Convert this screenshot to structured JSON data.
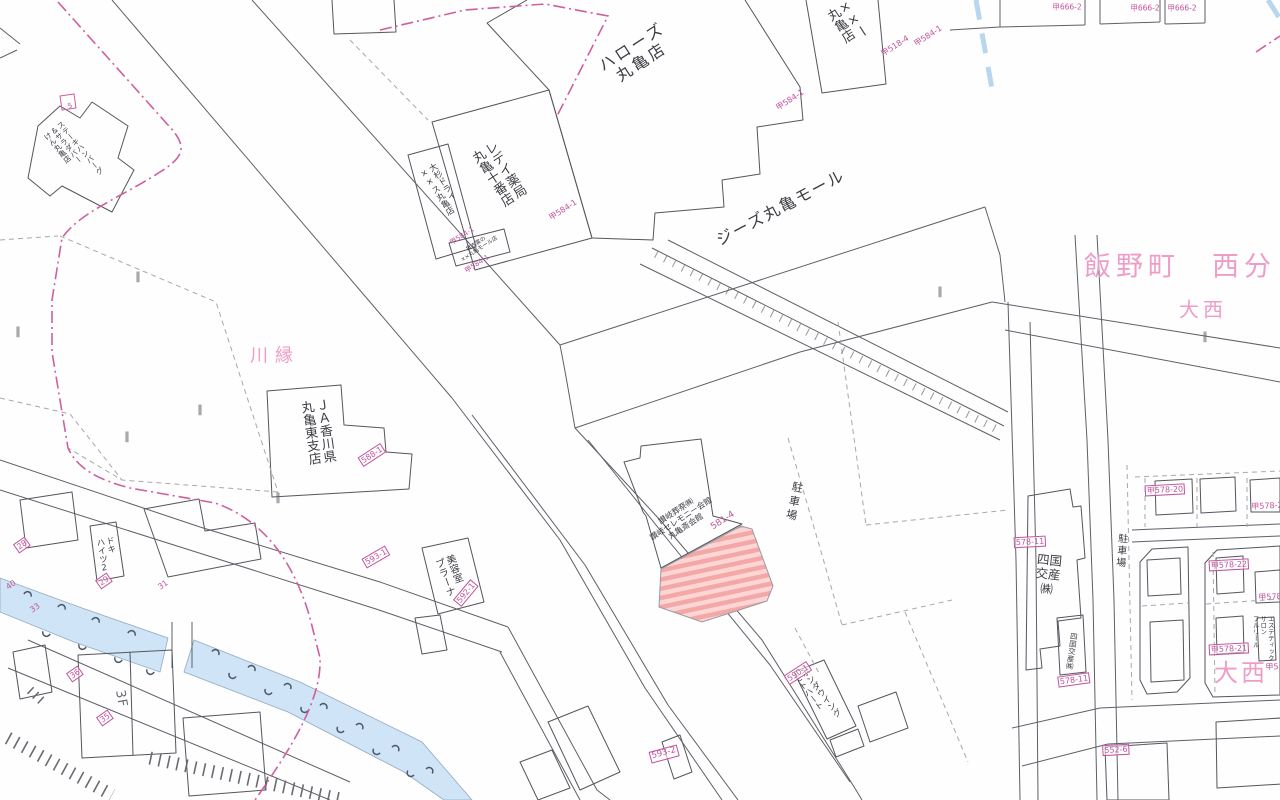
{
  "map": {
    "colors": {
      "parcel_number_pink": "#c2539c",
      "place_name_pink": "#ee9dc8",
      "boundary_pink": "#cf5f9f",
      "line_gray": "#5f5f68",
      "river_blue": "#cfe4f6",
      "hatch_pink_dark": "#f3a7a6",
      "hatch_pink_light": "#fbd6d5"
    },
    "highlighted_parcel": "581-4"
  },
  "labels": [
    {
      "n": "label-halows-marugame",
      "t": "ハローズ\n丸亀店",
      "x": 637,
      "y": 55,
      "r": -33,
      "s": 16,
      "c": "dark",
      "ls": 3
    },
    {
      "n": "label-gies-marugame-mall",
      "t": "ジーズ丸亀モール",
      "x": 781,
      "y": 208,
      "r": -28,
      "s": 16,
      "c": "dark",
      "ls": 2
    },
    {
      "n": "label-redei-pharmacy",
      "t": "レデイ薬局\n丸亀十番店",
      "x": 497,
      "y": 175,
      "r": -33,
      "s": 13,
      "c": "dark",
      "v": true
    },
    {
      "n": "label-osugi-dry",
      "t": "大杉ドライ\n××ス丸亀店",
      "x": 440,
      "y": 190,
      "r": -33,
      "s": 8.5,
      "c": "dark",
      "v": true
    },
    {
      "n": "label-rental-shop",
      "t": "貸衣裳の\n××丸亀モール店",
      "x": 478,
      "y": 247,
      "r": -33,
      "s": 5.5,
      "c": "dark"
    },
    {
      "n": "label-top-store",
      "t": "××ー\n丸亀店",
      "x": 846,
      "y": 24,
      "r": -33,
      "s": 13,
      "c": "dark",
      "v": true
    },
    {
      "n": "label-steak-ken",
      "t": "ステーキハンバーグ\n＆サラダバー\nけん丸亀店",
      "x": 73,
      "y": 154,
      "r": -40,
      "s": 7.5,
      "c": "dark",
      "v": true
    },
    {
      "n": "label-kawaberi",
      "t": "川縁",
      "x": 275,
      "y": 357,
      "r": 0,
      "s": 18,
      "c": "place",
      "ls": 7
    },
    {
      "n": "label-ja-kagawa",
      "t": "ＪＡ香川県\n丸亀東支店",
      "x": 316,
      "y": 432,
      "r": -8,
      "s": 13,
      "c": "dark",
      "v": true
    },
    {
      "n": "label-iinocho-nishibun",
      "t": "飯野町　西分",
      "x": 1180,
      "y": 267,
      "r": 0,
      "s": 27,
      "c": "place",
      "ls": 5
    },
    {
      "n": "label-onishi-small",
      "t": "大西",
      "x": 1203,
      "y": 310,
      "r": 0,
      "s": 20,
      "c": "place",
      "ls": 4
    },
    {
      "n": "label-onishi-large",
      "t": "大西",
      "x": 1241,
      "y": 674,
      "r": 0,
      "s": 24,
      "c": "place",
      "ls": 3
    },
    {
      "n": "label-sanuki-ceremony",
      "t": "讃岐葬祭㈱\n讃岐セレモニー会館\n丸亀斎会館",
      "x": 681,
      "y": 519,
      "r": -33,
      "s": 8,
      "c": "dark"
    },
    {
      "n": "label-parking-center",
      "t": "駐車場",
      "x": 793,
      "y": 502,
      "r": 12,
      "s": 11,
      "c": "dark",
      "v": true,
      "ls": 3
    },
    {
      "n": "label-parking-right",
      "t": "駐車場",
      "x": 1120,
      "y": 551,
      "r": 5,
      "s": 10,
      "c": "dark",
      "v": true,
      "ls": 2
    },
    {
      "n": "label-honda-wing",
      "t": "ホンダウイング\nモトハート",
      "x": 816,
      "y": 697,
      "r": -38,
      "s": 8.5,
      "c": "dark",
      "v": true
    },
    {
      "n": "label-biyoshitsu-prana",
      "t": "美容室\nプラーナ",
      "x": 449,
      "y": 576,
      "r": -20,
      "s": 10,
      "c": "dark",
      "v": true
    },
    {
      "n": "label-doki-heights",
      "t": "ドキ\nハイツ2",
      "x": 106,
      "y": 555,
      "r": -10,
      "s": 8.5,
      "c": "dark",
      "v": true
    },
    {
      "n": "label-shikoku-kosan",
      "t": "四国\n交産\n㈱",
      "x": 1048,
      "y": 575,
      "r": 6,
      "s": 12.5,
      "c": "dark"
    },
    {
      "n": "label-shikoku-kosan-small",
      "t": "四国交産㈱",
      "x": 1071,
      "y": 651,
      "r": 8,
      "s": 7.5,
      "c": "dark",
      "v": true
    },
    {
      "n": "label-esthetic-salon",
      "t": "エステティック\nサロン\nフルリール",
      "x": 1262,
      "y": 638,
      "r": 0,
      "s": 6.5,
      "c": "dark",
      "v": true
    },
    {
      "n": "label-3f",
      "t": "3F",
      "x": 120,
      "y": 699,
      "r": 80,
      "s": 13,
      "c": "gray",
      "ls": 1
    },
    {
      "n": "parcel-ko584-1-a",
      "t": "甲584-1",
      "x": 790,
      "y": 100,
      "r": -33,
      "s": 8,
      "c": "pink"
    },
    {
      "n": "parcel-ko518-4",
      "t": "甲518-4",
      "x": 895,
      "y": 46,
      "r": -33,
      "s": 8,
      "c": "pink"
    },
    {
      "n": "parcel-ko584-1-b",
      "t": "甲584-1",
      "x": 928,
      "y": 36,
      "r": -33,
      "s": 8,
      "c": "pink"
    },
    {
      "n": "parcel-ko584-1-c",
      "t": "甲584-1",
      "x": 563,
      "y": 210,
      "r": -33,
      "s": 8,
      "c": "pink"
    },
    {
      "n": "parcel-ko584-1-d",
      "t": "甲584-1",
      "x": 462,
      "y": 236,
      "r": -33,
      "s": 7,
      "c": "pink"
    },
    {
      "n": "parcel-ko584-1-e",
      "t": "甲584-1",
      "x": 477,
      "y": 264,
      "r": -33,
      "s": 7,
      "c": "pink"
    },
    {
      "n": "parcel-588-1",
      "t": "588-1",
      "x": 372,
      "y": 455,
      "r": -33,
      "s": 8,
      "c": "pink",
      "b": true
    },
    {
      "n": "parcel-593-1",
      "t": "593-1",
      "x": 376,
      "y": 557,
      "r": -30,
      "s": 8,
      "c": "pink",
      "b": true
    },
    {
      "n": "parcel-592-1",
      "t": "592-1",
      "x": 466,
      "y": 593,
      "r": -50,
      "s": 8,
      "c": "pink",
      "b": true
    },
    {
      "n": "parcel-581-4",
      "t": "581-4",
      "x": 723,
      "y": 521,
      "r": -33,
      "s": 9,
      "c": "pink"
    },
    {
      "n": "parcel-590-1",
      "t": "590-1",
      "x": 798,
      "y": 673,
      "r": -33,
      "s": 8,
      "c": "pink",
      "b": true
    },
    {
      "n": "parcel-593-2",
      "t": "593-2",
      "x": 664,
      "y": 754,
      "r": -15,
      "s": 8.5,
      "c": "pink",
      "b": true
    },
    {
      "n": "parcel-578-11-a",
      "t": "578-11",
      "x": 1030,
      "y": 542,
      "r": -3,
      "s": 8,
      "c": "pink",
      "b": true
    },
    {
      "n": "parcel-578-11-b",
      "t": "578-11",
      "x": 1074,
      "y": 680,
      "r": -8,
      "s": 8,
      "c": "pink",
      "b": true
    },
    {
      "n": "parcel-ko578-20",
      "t": "甲578-20",
      "x": 1165,
      "y": 490,
      "r": -3,
      "s": 8,
      "c": "pink",
      "b": true
    },
    {
      "n": "parcel-ko578-2",
      "t": "甲578-2",
      "x": 1267,
      "y": 506,
      "r": -3,
      "s": 8,
      "c": "pink"
    },
    {
      "n": "parcel-ko578-22",
      "t": "甲578-22",
      "x": 1229,
      "y": 565,
      "r": -3,
      "s": 8,
      "c": "pink",
      "b": true
    },
    {
      "n": "parcel-ko578-x",
      "t": "甲578",
      "x": 1270,
      "y": 597,
      "r": -3,
      "s": 8,
      "c": "pink"
    },
    {
      "n": "parcel-ko578-21",
      "t": "甲578-21",
      "x": 1229,
      "y": 649,
      "r": -3,
      "s": 8,
      "c": "pink",
      "b": true
    },
    {
      "n": "parcel-ko5-x",
      "t": "甲5",
      "x": 1272,
      "y": 667,
      "r": -3,
      "s": 8,
      "c": "pink"
    },
    {
      "n": "parcel-552-6",
      "t": "552-6",
      "x": 1116,
      "y": 750,
      "r": -3,
      "s": 8,
      "c": "pink",
      "b": true
    },
    {
      "n": "parcel-ko666-2-a",
      "t": "甲666-2",
      "x": 1067,
      "y": 8,
      "r": 0,
      "s": 7.5,
      "c": "pink"
    },
    {
      "n": "parcel-ko666-2-b",
      "t": "甲666-2",
      "x": 1145,
      "y": 9,
      "r": 0,
      "s": 7.5,
      "c": "pink"
    },
    {
      "n": "parcel-ko666-2-c",
      "t": "甲666-2",
      "x": 1182,
      "y": 9,
      "r": 0,
      "s": 7.5,
      "c": "pink"
    },
    {
      "n": "parcel-28",
      "t": "28",
      "x": 22,
      "y": 545,
      "r": -35,
      "s": 8,
      "c": "pink",
      "b": true
    },
    {
      "n": "parcel-29",
      "t": "29",
      "x": 104,
      "y": 581,
      "r": -35,
      "s": 8,
      "c": "pink",
      "b": true
    },
    {
      "n": "parcel-40",
      "t": "40",
      "x": 11,
      "y": 585,
      "r": -35,
      "s": 8,
      "c": "pink"
    },
    {
      "n": "parcel-33",
      "t": "33",
      "x": 35,
      "y": 608,
      "r": -35,
      "s": 8,
      "c": "pink"
    },
    {
      "n": "parcel-31",
      "t": "31",
      "x": 163,
      "y": 585,
      "r": -35,
      "s": 8,
      "c": "pink"
    },
    {
      "n": "parcel-36",
      "t": "36",
      "x": 75,
      "y": 674,
      "r": -35,
      "s": 8,
      "c": "pink",
      "b": true
    },
    {
      "n": "parcel-35",
      "t": "35",
      "x": 105,
      "y": 718,
      "r": -35,
      "s": 8,
      "c": "pink",
      "b": true
    },
    {
      "n": "parcel-5",
      "t": "5",
      "x": 70,
      "y": 106,
      "r": -20,
      "s": 7,
      "c": "pink"
    },
    {
      "n": "field-mark-1",
      "t": "‖",
      "x": 138,
      "y": 277,
      "r": 0,
      "s": 11,
      "c": "gray"
    },
    {
      "n": "field-mark-2",
      "t": "‖",
      "x": 18,
      "y": 332,
      "r": 0,
      "s": 11,
      "c": "gray"
    },
    {
      "n": "field-mark-3",
      "t": "‖",
      "x": 278,
      "y": 498,
      "r": 0,
      "s": 11,
      "c": "gray"
    },
    {
      "n": "field-mark-4",
      "t": "‖",
      "x": 200,
      "y": 410,
      "r": 0,
      "s": 11,
      "c": "gray"
    },
    {
      "n": "field-mark-5",
      "t": "‖",
      "x": 127,
      "y": 437,
      "r": 0,
      "s": 11,
      "c": "gray"
    },
    {
      "n": "field-mark-6",
      "t": "‖",
      "x": 940,
      "y": 292,
      "r": 0,
      "s": 11,
      "c": "gray"
    },
    {
      "n": "field-mark-7",
      "t": "‖",
      "x": 1205,
      "y": 337,
      "r": 0,
      "s": 11,
      "c": "gray"
    }
  ]
}
